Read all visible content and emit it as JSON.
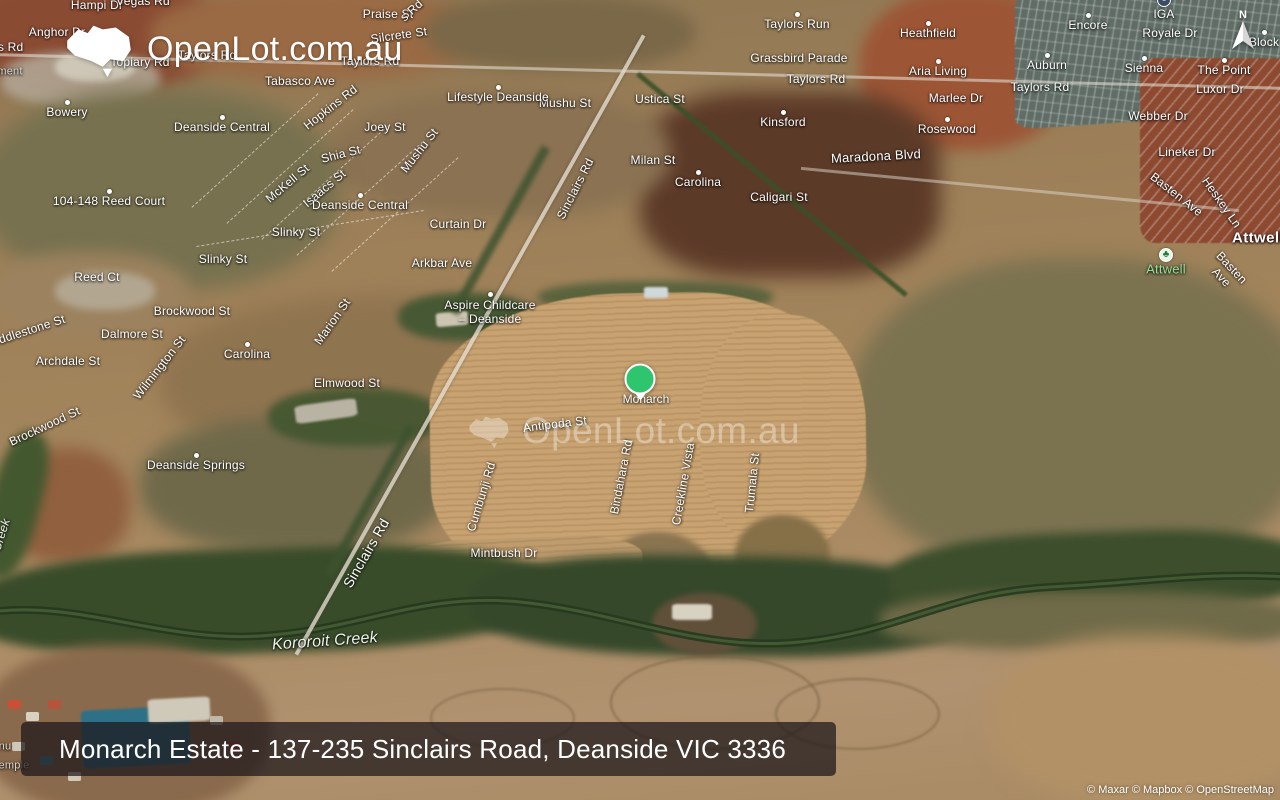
{
  "brand": {
    "name": "OpenLot.com.au"
  },
  "watermark": {
    "text": "OpenLot.com.au"
  },
  "banner": {
    "text": "Monarch Estate - 137-235 Sinclairs Road, Deanside VIC 3336"
  },
  "attribution": {
    "text": "© Maxar © Mapbox © OpenStreetMap"
  },
  "compass": {
    "letter": "N"
  },
  "marker": {
    "label": "Monarch",
    "color": "#2fc56f",
    "x": 640,
    "y": 379
  },
  "colors": {
    "marker_green": "#2fc56f",
    "park_label_green": "#93e29a",
    "banner_bg": "rgba(28,22,26,0.72)"
  },
  "map_labels": [
    {
      "t": "Hampi Dr",
      "x": 97,
      "y": 6
    },
    {
      "t": "Vegas Rd",
      "x": 143,
      "y": 2
    },
    {
      "t": "Anghor Dr",
      "x": 57,
      "y": 33
    },
    {
      "t": "Praise St",
      "x": 388,
      "y": 15
    },
    {
      "t": "s Rd",
      "x": 412,
      "y": 11,
      "r": -42
    },
    {
      "t": "Silcrete St",
      "x": 399,
      "y": 36,
      "r": -8
    },
    {
      "t": "Taylors Rd",
      "x": -6,
      "y": 48
    },
    {
      "t": "Taylors Rd",
      "x": 207,
      "y": 56
    },
    {
      "t": "Topiary Rd",
      "x": 140,
      "y": 63
    },
    {
      "t": "Taylors Rd",
      "x": 370,
      "y": 62
    },
    {
      "t": "Tabasco Ave",
      "x": 300,
      "y": 82
    },
    {
      "t": "Hopkins Rd",
      "x": 331,
      "y": 108,
      "r": -38
    },
    {
      "t": "Joey St",
      "x": 385,
      "y": 128
    },
    {
      "t": "Mushu St",
      "x": 420,
      "y": 151,
      "r": -52
    },
    {
      "t": "Shia St",
      "x": 341,
      "y": 155,
      "r": -14
    },
    {
      "t": "McKell St",
      "x": 288,
      "y": 184,
      "r": -40
    },
    {
      "t": "Isaacs St",
      "x": 325,
      "y": 189,
      "r": -40
    },
    {
      "t": "Mushu St",
      "x": 565,
      "y": 104
    },
    {
      "t": "Ustica St",
      "x": 660,
      "y": 100
    },
    {
      "t": "Milan St",
      "x": 653,
      "y": 161
    },
    {
      "t": "Caligari St",
      "x": 779,
      "y": 198
    },
    {
      "t": "Curtain Dr",
      "x": 458,
      "y": 225
    },
    {
      "t": "Slinky St",
      "x": 296,
      "y": 233
    },
    {
      "t": "Slinky St",
      "x": 223,
      "y": 260
    },
    {
      "t": "Arkbar Ave",
      "x": 442,
      "y": 264
    },
    {
      "t": "Reed Ct",
      "x": 97,
      "y": 278
    },
    {
      "t": "Sinclairs Rd",
      "x": 576,
      "y": 189,
      "r": -63
    },
    {
      "t": "Grassbird Parade",
      "x": 799,
      "y": 59
    },
    {
      "t": "Taylors Rd",
      "x": 816,
      "y": 80
    },
    {
      "t": "Maradona Blvd",
      "x": 876,
      "y": 157,
      "r": -3,
      "s": 13
    },
    {
      "t": "Marlee Dr",
      "x": 956,
      "y": 99
    },
    {
      "t": "Taylors Rd",
      "x": 1040,
      "y": 88
    },
    {
      "t": "Royale Dr",
      "x": 1170,
      "y": 34
    },
    {
      "t": "Luxor Dr",
      "x": 1220,
      "y": 90
    },
    {
      "t": "Webber Dr",
      "x": 1158,
      "y": 117
    },
    {
      "t": "Lineker Dr",
      "x": 1187,
      "y": 153
    },
    {
      "t": "Basten Ave",
      "x": 1176,
      "y": 195,
      "r": 38
    },
    {
      "t": "Heskey Ln",
      "x": 1221,
      "y": 203,
      "r": 55
    },
    {
      "t": "Basten Ave",
      "x": 1226,
      "y": 273,
      "r": 47
    },
    {
      "t": "Brockwood St",
      "x": 192,
      "y": 312
    },
    {
      "t": "Dalmore St",
      "x": 132,
      "y": 335
    },
    {
      "t": "Middlestone St",
      "x": 26,
      "y": 332,
      "r": -18
    },
    {
      "t": "Archdale St",
      "x": 68,
      "y": 362
    },
    {
      "t": "Marion St",
      "x": 333,
      "y": 322,
      "r": -55
    },
    {
      "t": "Wilmington St",
      "x": 160,
      "y": 368,
      "r": -52
    },
    {
      "t": "Elmwood St",
      "x": 347,
      "y": 384
    },
    {
      "t": "Brockwood St",
      "x": 45,
      "y": 427,
      "r": -25
    },
    {
      "t": "Antipoda St",
      "x": 555,
      "y": 425,
      "r": -7
    },
    {
      "t": "Cumbunji Rd",
      "x": 482,
      "y": 497,
      "r": -73
    },
    {
      "t": "Bindahara Rd",
      "x": 622,
      "y": 477,
      "r": -79
    },
    {
      "t": "Creekline Vista",
      "x": 684,
      "y": 484,
      "r": -80
    },
    {
      "t": "Trumala St",
      "x": 753,
      "y": 483,
      "r": -84
    },
    {
      "t": "Mintbush Dr",
      "x": 504,
      "y": 554
    },
    {
      "t": "Sinclairs Rd",
      "x": 366,
      "y": 553,
      "r": -60,
      "s": 14
    },
    {
      "t": "Creek",
      "x": 2,
      "y": 535,
      "r": -72,
      "c": "water"
    },
    {
      "t": "Kororoit Creek",
      "x": 325,
      "y": 642,
      "r": -4,
      "c": "water",
      "s": 16
    },
    {
      "t": "Bowery",
      "x": 67,
      "y": 113,
      "c": "place",
      "d": 1
    },
    {
      "t": "Deanside Central",
      "x": 222,
      "y": 128,
      "c": "place",
      "d": 1
    },
    {
      "t": "104-148 Reed Court",
      "x": 109,
      "y": 202,
      "c": "place",
      "d": 1
    },
    {
      "t": "Deanside Central",
      "x": 360,
      "y": 206,
      "c": "place",
      "d": 1
    },
    {
      "t": "Lifestyle Deanside",
      "x": 498,
      "y": 98,
      "c": "place",
      "d": 1
    },
    {
      "t": "Taylors Run",
      "x": 797,
      "y": 25,
      "c": "place",
      "d": 1
    },
    {
      "t": "Kinsford",
      "x": 783,
      "y": 123,
      "c": "place",
      "d": 1
    },
    {
      "t": "Carolina",
      "x": 698,
      "y": 183,
      "c": "place",
      "d": 1
    },
    {
      "t": "Heathfield",
      "x": 928,
      "y": 34,
      "c": "place",
      "d": 1
    },
    {
      "t": "Aria Living",
      "x": 938,
      "y": 72,
      "c": "place",
      "d": 1
    },
    {
      "t": "Rosewood",
      "x": 947,
      "y": 130,
      "c": "place",
      "d": 1
    },
    {
      "t": "Auburn",
      "x": 1047,
      "y": 66,
      "c": "place",
      "d": 1
    },
    {
      "t": "Encore",
      "x": 1088,
      "y": 26,
      "c": "place",
      "d": 1
    },
    {
      "t": "Sienna",
      "x": 1144,
      "y": 69,
      "c": "place",
      "d": 1
    },
    {
      "t": "The Point",
      "x": 1224,
      "y": 71,
      "c": "place",
      "d": 1
    },
    {
      "t": "Block",
      "x": 1264,
      "y": 43,
      "c": "place",
      "d": 1
    },
    {
      "t": "Carolina",
      "x": 247,
      "y": 355,
      "c": "place",
      "d": 1
    },
    {
      "t": "Deanside Springs",
      "x": 196,
      "y": 466,
      "c": "place",
      "d": 1
    },
    {
      "t": "Aspire Childcare\n– Deanside",
      "x": 490,
      "y": 313,
      "c": "place",
      "d": 1,
      "dy": -19
    },
    {
      "t": "IGA",
      "x": 1164,
      "y": 15,
      "c": "place",
      "i": "store"
    },
    {
      "t": "Attwell",
      "x": 1166,
      "y": 270,
      "c": "green",
      "s": 13,
      "i": "park"
    },
    {
      "t": "Attwell",
      "x": 1258,
      "y": 238,
      "c": "suburb"
    },
    {
      "t": "ment",
      "x": 10,
      "y": 72,
      "c": "dim"
    },
    {
      "t": "nu",
      "x": 5,
      "y": 747,
      "c": "dim"
    },
    {
      "t": "emple",
      "x": 14,
      "y": 766,
      "c": "dim"
    }
  ]
}
